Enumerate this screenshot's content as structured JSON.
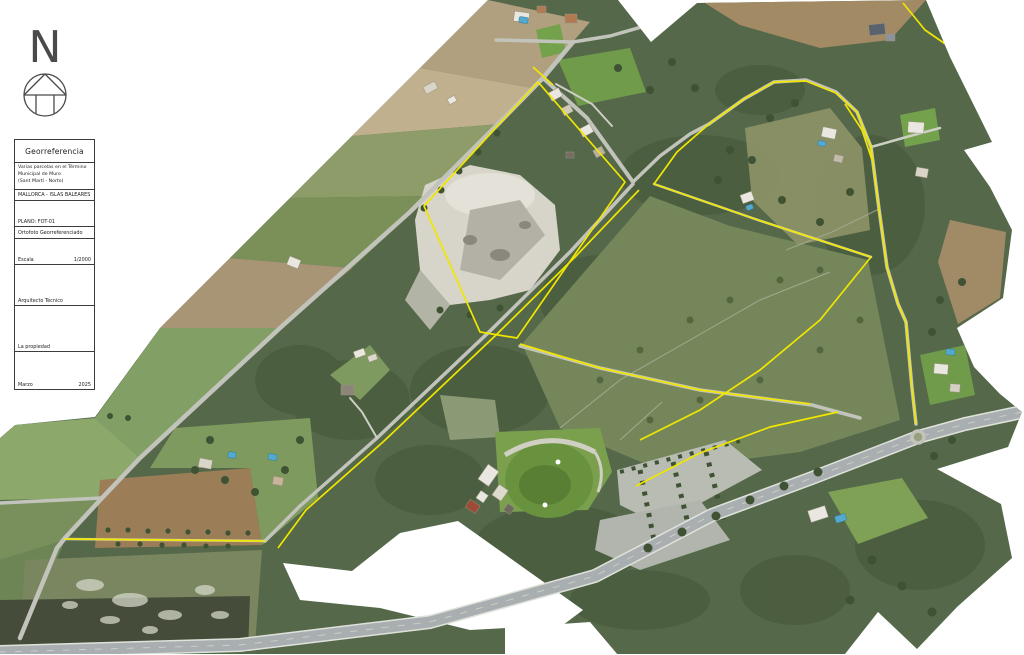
{
  "north_arrow": {
    "label": "N"
  },
  "title_block": {
    "title": "Georreferencia",
    "project": {
      "line1": "Varias parcelas en el Término",
      "line2": "Municipal de Muro",
      "line3": "(Sant Martí - Norte)"
    },
    "location": "MALLORCA - ISLAS BALEARES",
    "plan_label": "PLANO: FOT-01",
    "drawing_type": "Ortofoto Georreferenciado",
    "scale": {
      "label": "Escala",
      "value": "1/2000"
    },
    "architect_label": "Arquitecto Técnico",
    "owner_label": "La propiedad",
    "date": {
      "month": "Marzo",
      "year": "2025"
    }
  },
  "map": {
    "colors": {
      "background": "#ffffff",
      "forest": "#55684a",
      "forest_dark": "#46583b",
      "field_green": "#82a065",
      "field_tan": "#b0a07f",
      "plowed_brown": "#9b7e58",
      "quarry": "#d7d5ca",
      "lawn": "#69923f",
      "parking": "#b9bcb2",
      "road": "#c2c4bc",
      "track": "#cdcfc4",
      "highway": "#a9aeb0",
      "highway_edge": "#dfe2db",
      "building": "#e9e7df",
      "roof_red": "#9d4a37",
      "pool": "#55a9cd",
      "parcel_line": "#f0e600"
    }
  }
}
